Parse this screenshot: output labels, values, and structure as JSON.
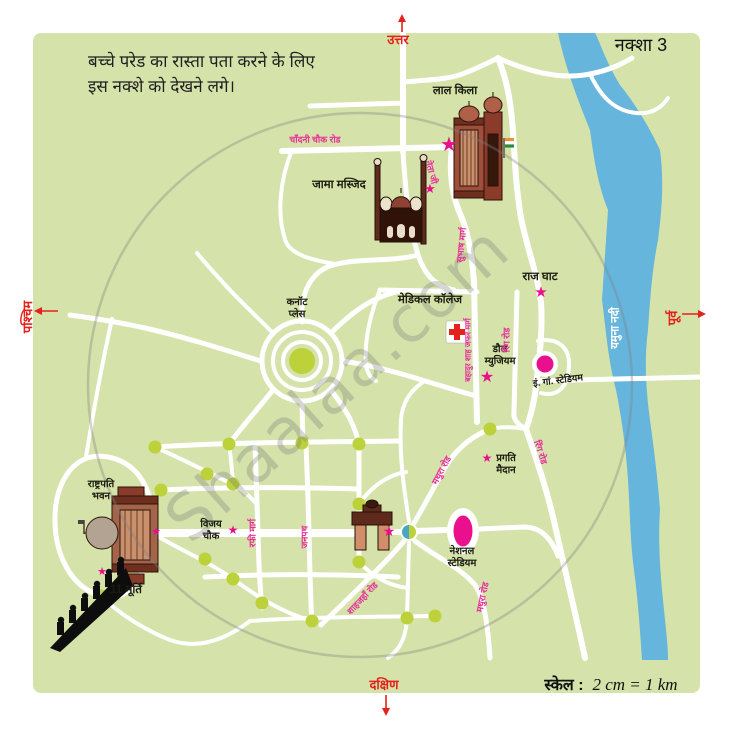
{
  "title": "नक्शा 3",
  "intro": {
    "line1": "बच्चे परेड का रास्ता पता करने के लिए",
    "line2": "इस नक्शे को देखने लगे।"
  },
  "directions": {
    "north": "उत्तर",
    "south": "दक्षिण",
    "east": "पूर्व",
    "west": "पश्चिम"
  },
  "scale": {
    "label": "स्केल",
    "separator": ":",
    "value": "2 cm = 1 km"
  },
  "watermark": "Shaalaa.com",
  "river_label": "यमुना नदी",
  "places": {
    "lal_qila": "लाल किला",
    "jama_masjid": "जामा मस्जिद",
    "raj_ghat": "राज घाट",
    "medical_college": "मेडिकल कॉलेज",
    "connaught_l1": "कनॉट",
    "connaught_l2": "प्लेस",
    "doll_l1": "डौल",
    "doll_l2": "म्युजियम",
    "ig_stadium": "इं. गां. स्टेडियम",
    "pragati_l1": "प्रगति",
    "pragati_l2": "मैदान",
    "vijay_l1": "विजय",
    "vijay_l2": "चौक",
    "rashtrapati_l1": "राष्ट्रपति",
    "rashtrapati_l2": "भवन",
    "national_l1": "नेशनल",
    "national_l2": "स्टेडियम",
    "murti11": "11 मूर्ति"
  },
  "roads": {
    "chandni_chowk": "चाँदनी चौक रोड",
    "netaji": "नेता जी",
    "subhash_marg": "सुभाष मार्ग",
    "bahadur_shah_zafar_marg": "बहादुर शाह जफर मार्ग",
    "ring_road_n": "रिंग रोड",
    "ring_road_s": "रिंग रोड",
    "mathura_road_n": "मथुरा रोड",
    "mathura_road_s": "मथुरा रोड",
    "shahjahan_road": "शाहजहाँ रोड",
    "rafi_marg": "रफी मार्ग",
    "janpath": "जनपथ"
  },
  "colors": {
    "map_background": "#d5e2a9",
    "river": "#66b5dc",
    "road": "#ffffff",
    "roundabout": "#bcd13a",
    "landmark_pink": "#ea0f8c",
    "road_label_pink": "#e8309b",
    "direction_red": "#e3231b",
    "building_red": "#9e4e3a"
  }
}
